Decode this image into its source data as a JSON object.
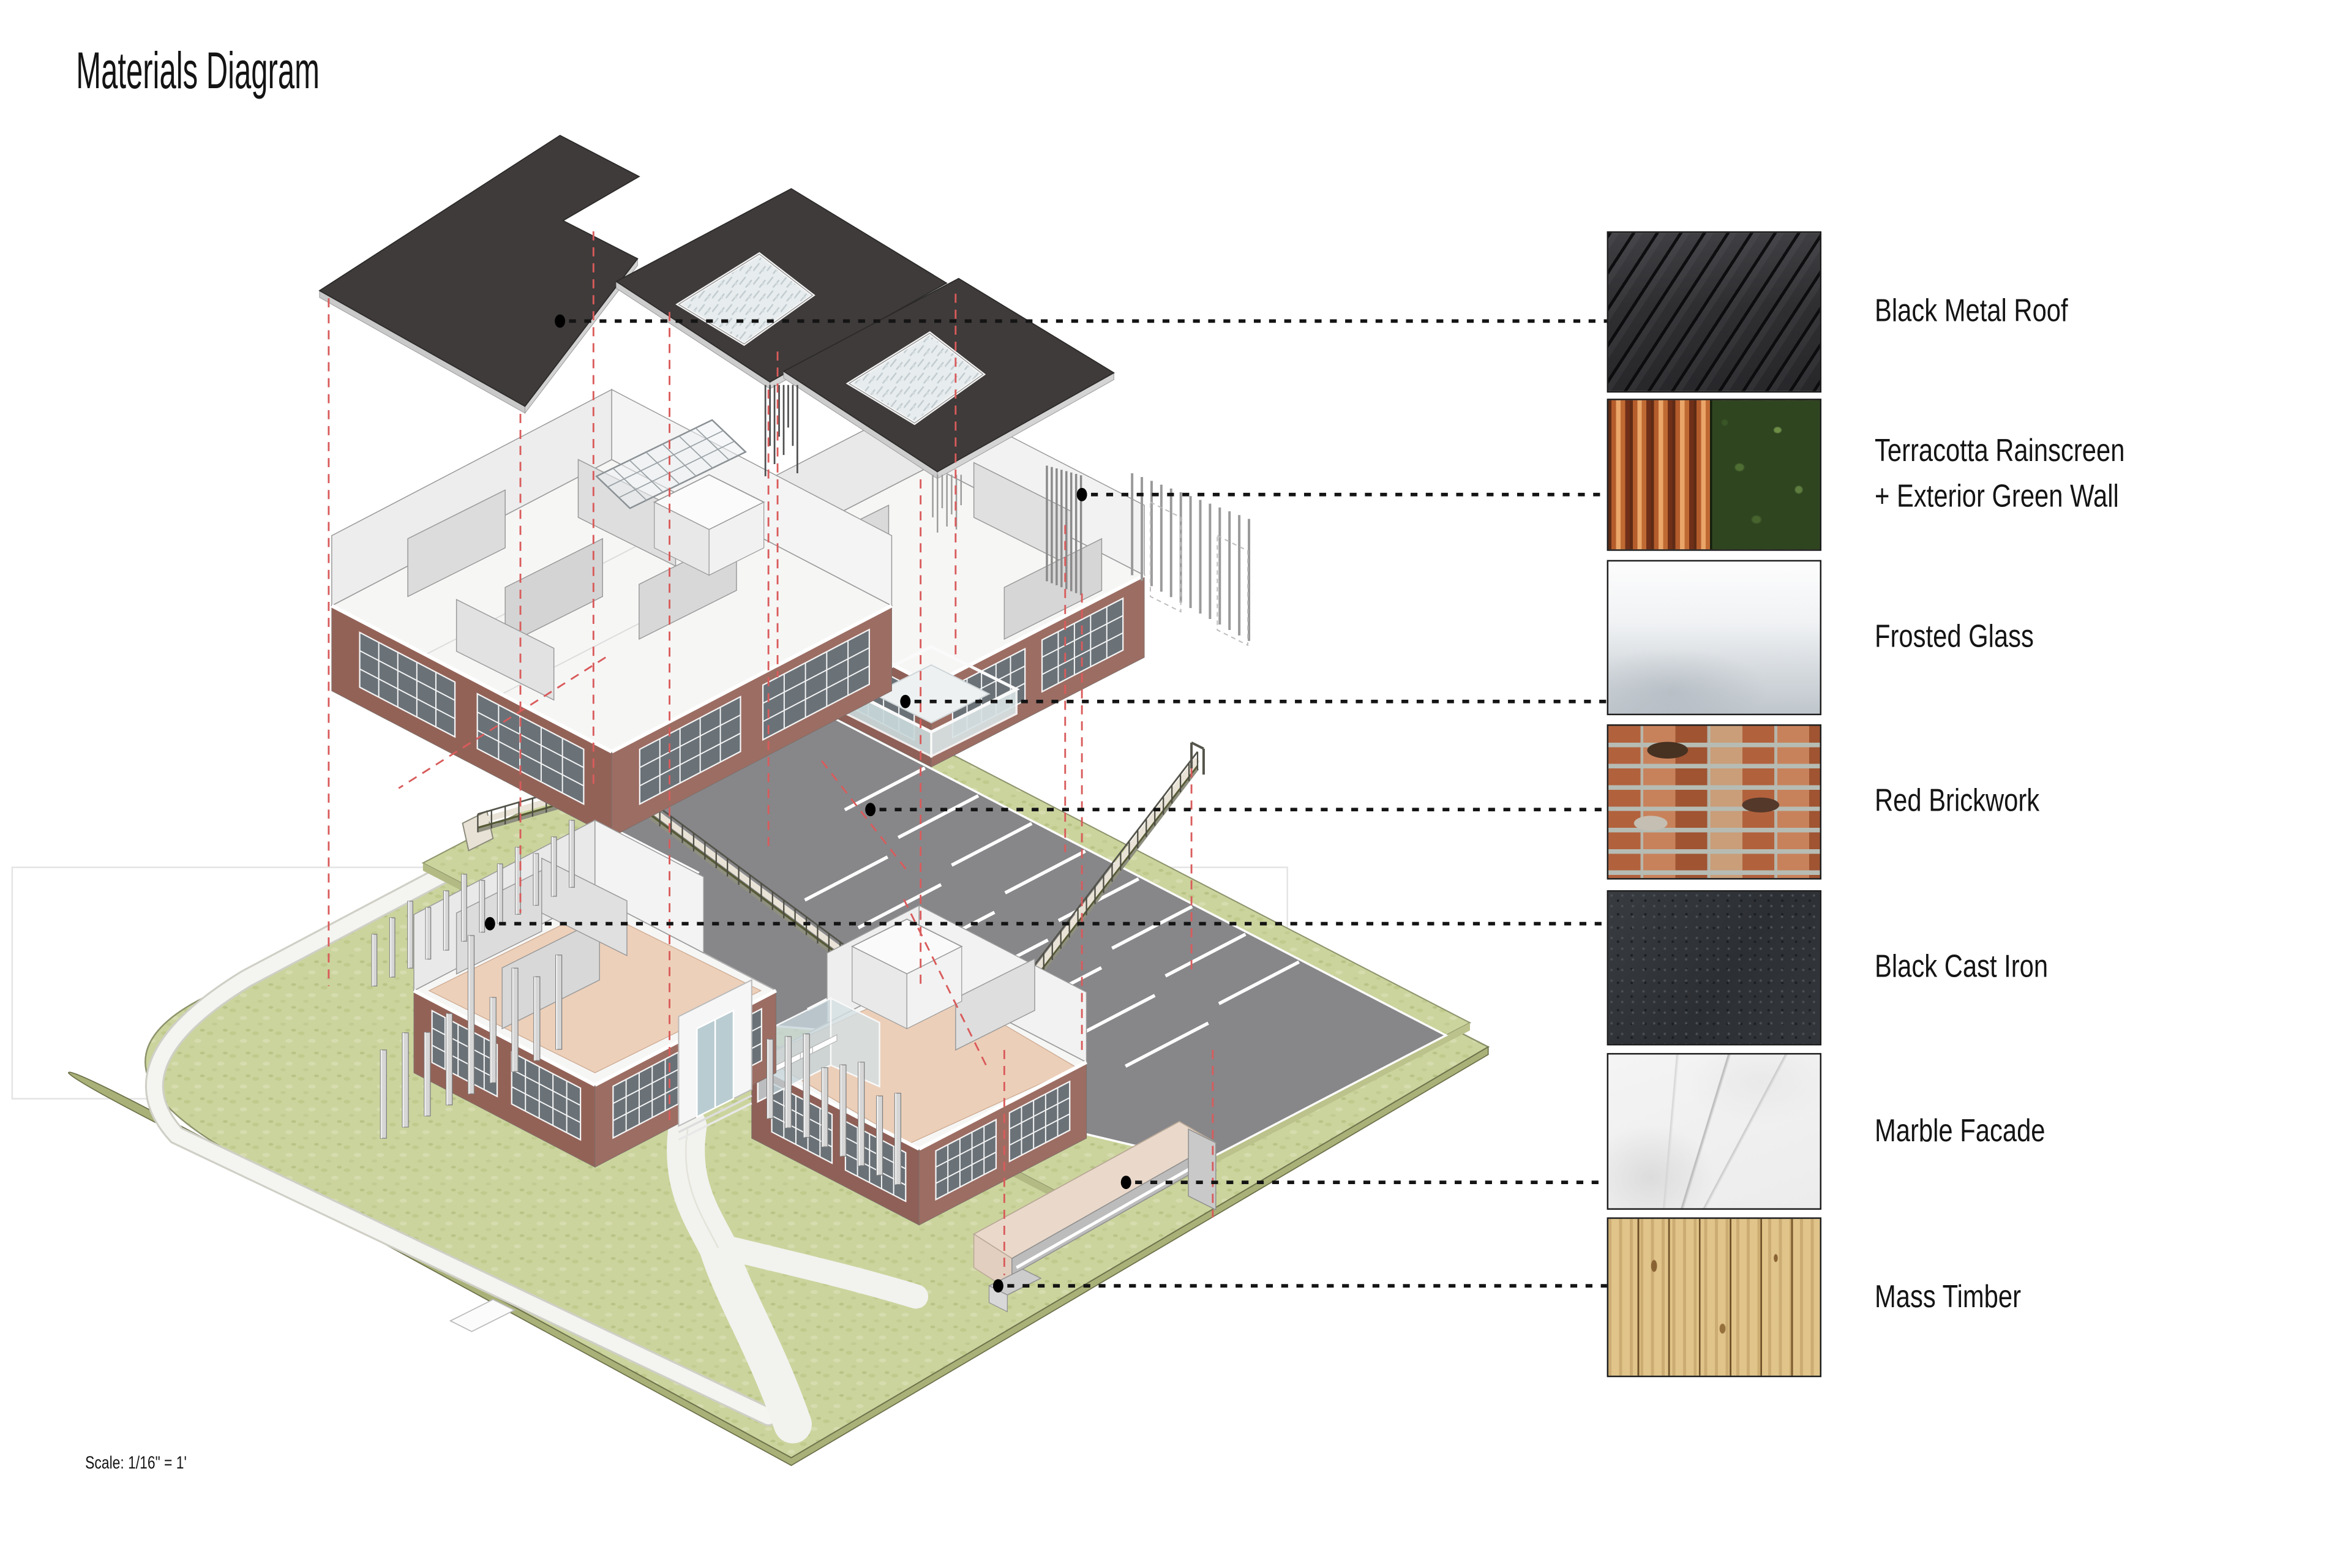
{
  "title": "Materials Diagram",
  "scale_note": "Scale: 1/16\" = 1'",
  "legend": {
    "items": [
      {
        "name": "black-metal-roof",
        "label": "Black Metal Roof"
      },
      {
        "name": "terracotta-rainscreen-green-wall",
        "label": "Terracotta Rainscreen\n+ Exterior Green Wall"
      },
      {
        "name": "frosted-glass",
        "label": "Frosted Glass"
      },
      {
        "name": "red-brickwork",
        "label": "Red Brickwork"
      },
      {
        "name": "black-cast-iron",
        "label": "Black Cast Iron"
      },
      {
        "name": "marble-facade",
        "label": "Marble Facade"
      },
      {
        "name": "mass-timber",
        "label": "Mass Timber"
      }
    ]
  },
  "colors": {
    "roof_plate": "#3e3b3a",
    "brick_wall": "#9a6a60",
    "lawn_green": "#cbd49d",
    "asphalt_gray": "#87878a",
    "floor_pink": "#edd0ba",
    "projection_line_red": "#d95b5b",
    "leader_line_black": "#111111",
    "frosted_glass_blue": "#ccdadc",
    "timber_tan": "#ead8c8",
    "page_background": "#ffffff"
  }
}
